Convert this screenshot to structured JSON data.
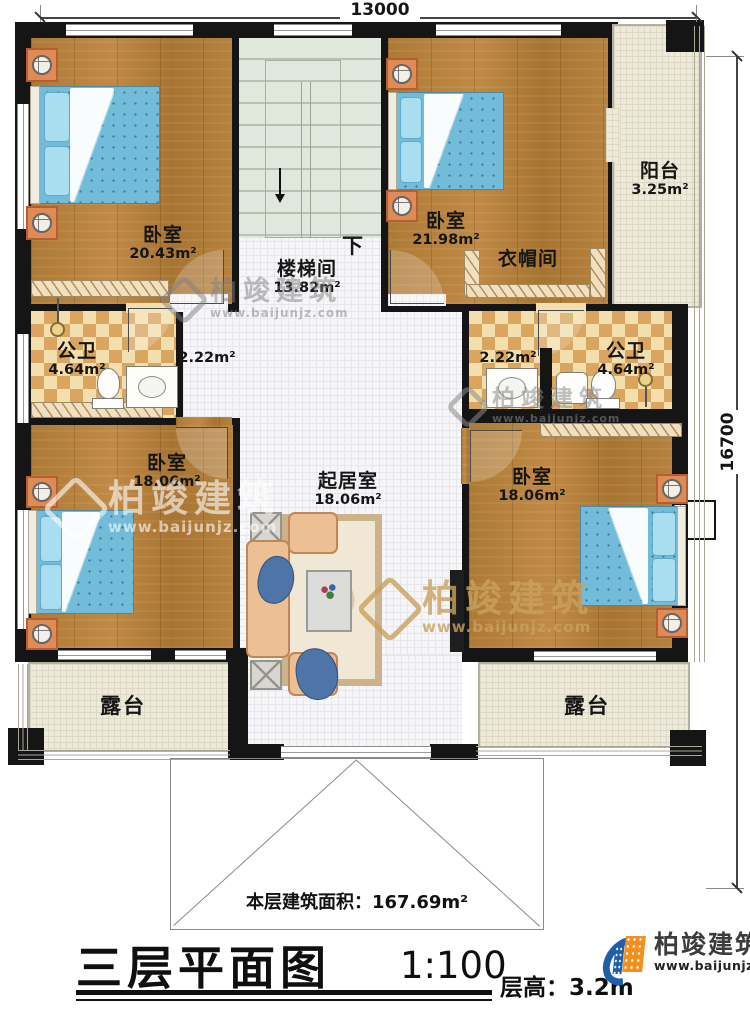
{
  "plan": {
    "dim_top": "13000",
    "dim_right": "16700",
    "stair_down": "下",
    "roof_label": "本层建筑面积：",
    "roof_value": "167.69m²",
    "rooms": {
      "bedroom_tl": {
        "name": "卧室",
        "area": "20.43m²"
      },
      "stairwell": {
        "name": "楼梯间",
        "area": "13.82m²"
      },
      "bedroom_tr": {
        "name": "卧室",
        "area": "21.98m²"
      },
      "cloakroom": {
        "name": "衣帽间"
      },
      "balcony": {
        "name": "阳台",
        "area": "3.25m²"
      },
      "bath_left": {
        "name": "公卫",
        "area": "4.64m²"
      },
      "bath_right": {
        "name": "公卫",
        "area": "4.64m²"
      },
      "hall_left": {
        "area": "2.22m²"
      },
      "hall_right": {
        "area": "2.22m²"
      },
      "bedroom_ml": {
        "name": "卧室",
        "area": "18.06m²"
      },
      "living": {
        "name": "起居室",
        "area": "18.06m²"
      },
      "bedroom_mr": {
        "name": "卧室",
        "area": "18.06m²"
      },
      "terrace_left": {
        "name": "露台"
      },
      "terrace_right": {
        "name": "露台"
      }
    }
  },
  "title_block": {
    "title": "三层平面图",
    "scale": "1:100",
    "floor_height_label": "层高：",
    "floor_height_value": "3.2m"
  },
  "branding": {
    "company": "柏竣建筑",
    "website": "www.baijunjz.com"
  },
  "colors": {
    "wall": "#151515",
    "wood_floor": "#b1803d",
    "stair_floor": "#e0e7dc",
    "tile_light": "#f3dfae",
    "tile_dark": "#d9a55f",
    "terrace_floor": "#edeadb",
    "bed_blue": "#72bcd9",
    "logo_blue": "#1f5fa8",
    "logo_orange": "#f0901e"
  }
}
